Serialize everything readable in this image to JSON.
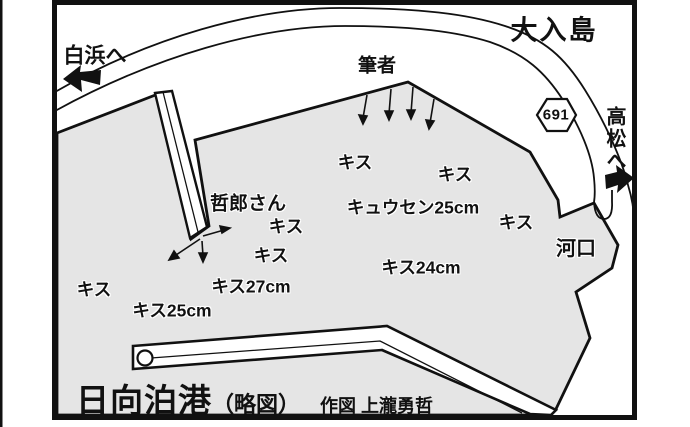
{
  "colors": {
    "water": "#e5e5e5",
    "ink": "#1a1a1a",
    "land": "#ffffff"
  },
  "landmarks": {
    "island": "大入島",
    "road_badge": "691",
    "to_shirahama": "白浜へ",
    "to_takamatsu": "高松へ",
    "river_mouth": "河口",
    "angler_author": "筆者",
    "angler_tetsuro": "哲郎さん"
  },
  "fish_labels": [
    {
      "text": "キス",
      "x": 355,
      "y": 163
    },
    {
      "text": "キス",
      "x": 455,
      "y": 175
    },
    {
      "text": "キュウセン25cm",
      "x": 413,
      "y": 208
    },
    {
      "text": "キス",
      "x": 516,
      "y": 223
    },
    {
      "text": "キス",
      "x": 286,
      "y": 227
    },
    {
      "text": "キス",
      "x": 271,
      "y": 256
    },
    {
      "text": "キス24cm",
      "x": 421,
      "y": 268
    },
    {
      "text": "キス27cm",
      "x": 251,
      "y": 287
    },
    {
      "text": "キス",
      "x": 94,
      "y": 290
    },
    {
      "text": "キス25cm",
      "x": 172,
      "y": 311
    }
  ],
  "footer": {
    "port_name": "日向泊港",
    "map_type": "（略図）",
    "credit": "作図 上瀧勇哲"
  }
}
